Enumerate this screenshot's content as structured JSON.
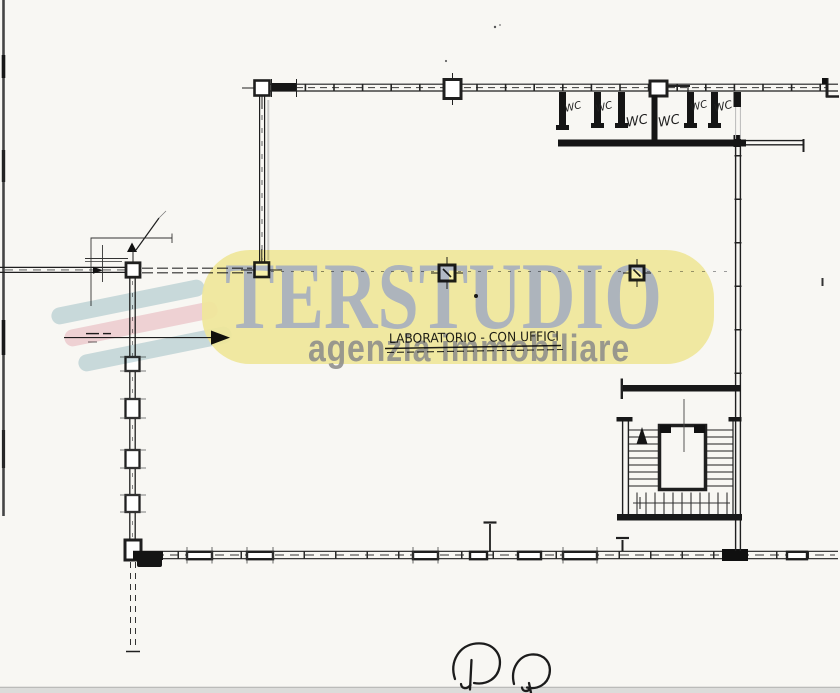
{
  "watermark": {
    "brand": "TERSTUDIO",
    "tagline": "agenzia immobiliare",
    "banner_color": "#f6efa2",
    "brand_color": "#a9b3cb",
    "tagline_color": "#8d8e90",
    "bar_colors": [
      "#c9dde2",
      "#f4d4da",
      "#c9dde2"
    ]
  },
  "plan": {
    "room_label": "LABORATORIO - CON UFFICI",
    "wc_labels": [
      "WC",
      "WC",
      "WC",
      "WC",
      "WC",
      "WC"
    ],
    "ink_color": "#1f1f1f",
    "paper_color": "#f8f7f3"
  }
}
